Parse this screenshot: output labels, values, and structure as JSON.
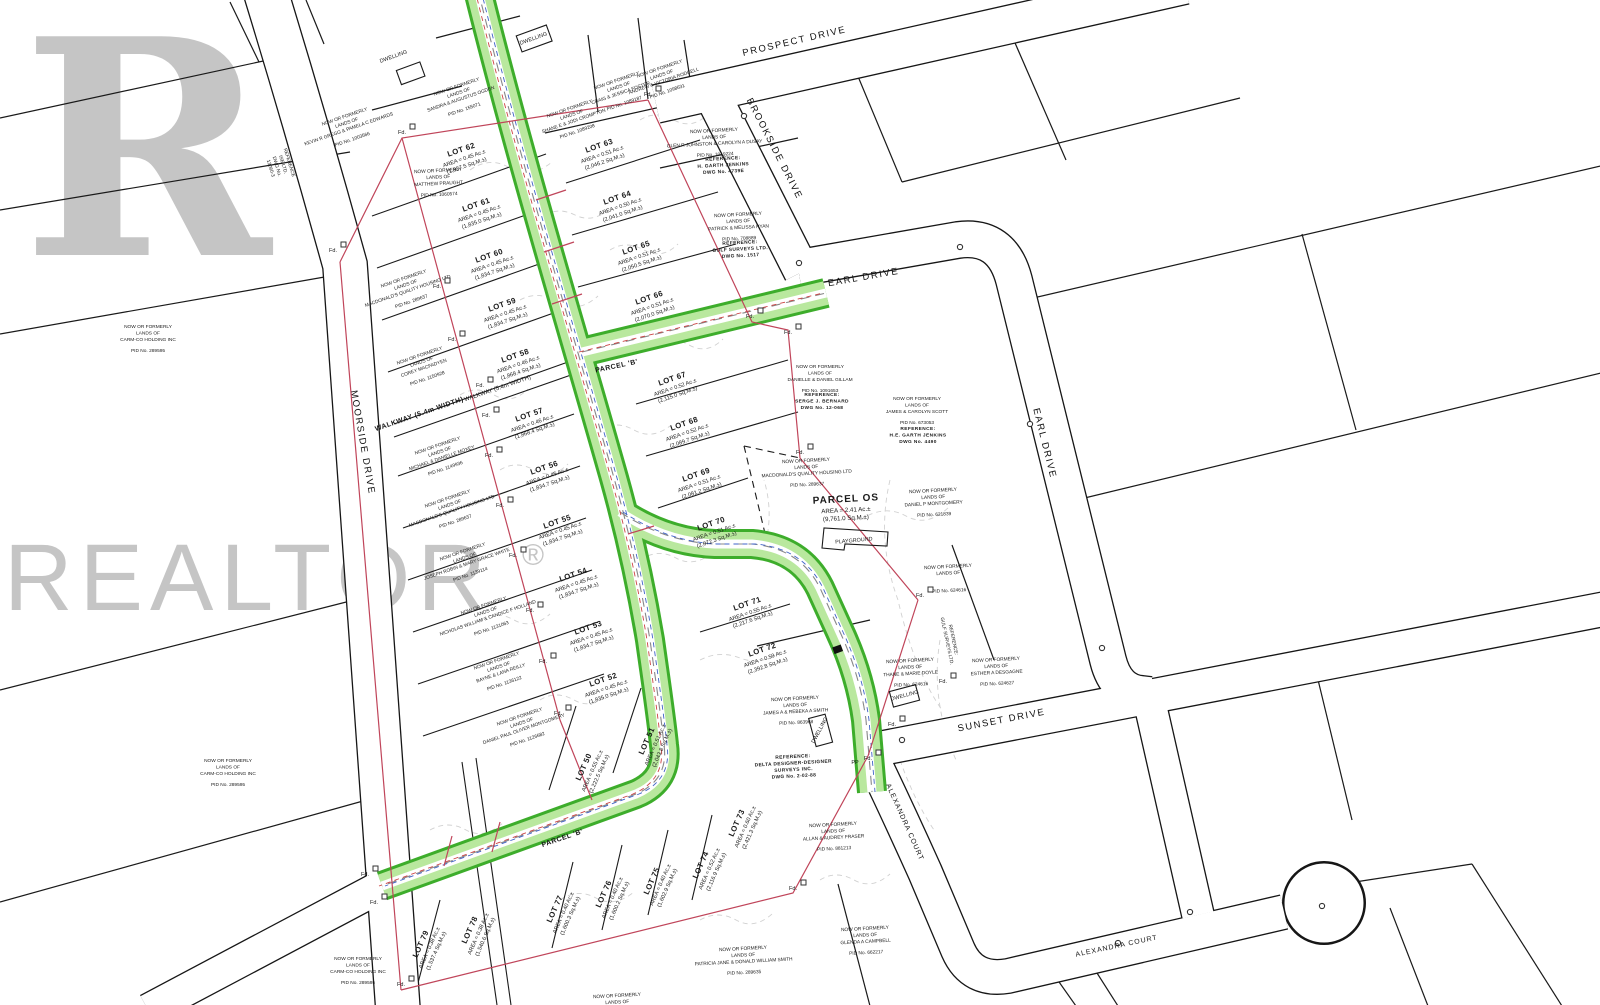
{
  "watermark": {
    "logo_letter": "R",
    "brand": "REALTOR",
    "registered": "®"
  },
  "streets": {
    "prospect": "PROSPECT DRIVE",
    "brookside": "BROOKSIDE DRIVE",
    "earl": "EARL DRIVE",
    "moorside": "MOORSIDE DRIVE",
    "sunset": "SUNSET DRIVE",
    "alexandra": "ALEXANDRA COURT",
    "walkway": "WALKWAY (5.4m WIDTH)",
    "parcel_b": "PARCEL 'B'"
  },
  "parcel_os": {
    "name": "PARCEL OS",
    "area_ac": "AREA = 2.41 Ac.±",
    "area_m": "(9,761.0 Sq.M.±)",
    "playground": "PLAYGROUND"
  },
  "labels": {
    "found": "Fd.",
    "pp": "PP",
    "dwelling": "DWELLING"
  },
  "owner_intro": [
    "NOW OR FORMERLY",
    "LANDS OF"
  ],
  "lots": [
    {
      "id": "LOT 50",
      "ac": "AREA = 0.55 Ac.±",
      "m": "(2,222.5 Sq.M.±)",
      "x": 586,
      "y": 768,
      "r": -66
    },
    {
      "id": "LOT 51",
      "ac": "AREA = 0.51 Ac.±",
      "m": "(2,043.8 Sq.M.±)",
      "x": 649,
      "y": 742,
      "r": -66
    },
    {
      "id": "LOT 52",
      "ac": "AREA = 0.45 Ac.±",
      "m": "(1,835.0 Sq.M.±)",
      "x": 604,
      "y": 682,
      "r": -19
    },
    {
      "id": "LOT 53",
      "ac": "AREA = 0.45 Ac.±",
      "m": "(1,834.7 Sq.M.±)",
      "x": 589,
      "y": 630,
      "r": -19
    },
    {
      "id": "LOT 54",
      "ac": "AREA = 0.45 Ac.±",
      "m": "(1,834.7 Sq.M.±)",
      "x": 574,
      "y": 577,
      "r": -19
    },
    {
      "id": "LOT 55",
      "ac": "AREA = 0.45 Ac.±",
      "m": "(1,834.7 Sq.M.±)",
      "x": 558,
      "y": 524,
      "r": -19
    },
    {
      "id": "LOT 56",
      "ac": "AREA = 0.45 Ac.±",
      "m": "(1,834.7 Sq.M.±)",
      "x": 545,
      "y": 470,
      "r": -19
    },
    {
      "id": "LOT 57",
      "ac": "AREA = 0.46 Ac.±",
      "m": "(1,868.4 Sq.M.±)",
      "x": 530,
      "y": 417,
      "r": -19
    },
    {
      "id": "LOT 58",
      "ac": "AREA = 0.46 Ac.±",
      "m": "(1,868.4 Sq.M.±)",
      "x": 516,
      "y": 358,
      "r": -19
    },
    {
      "id": "LOT 59",
      "ac": "AREA = 0.45 Ac.±",
      "m": "(1,834.7 Sq.M.±)",
      "x": 503,
      "y": 307,
      "r": -19
    },
    {
      "id": "LOT 60",
      "ac": "AREA = 0.45 Ac.±",
      "m": "(1,834.7 Sq.M.±)",
      "x": 490,
      "y": 258,
      "r": -19
    },
    {
      "id": "LOT 61",
      "ac": "AREA = 0.45 Ac.±",
      "m": "(1,835.0 Sq.M.±)",
      "x": 477,
      "y": 207,
      "r": -19
    },
    {
      "id": "LOT 62",
      "ac": "AREA = 0.45 Ac.±",
      "m": "(1,837.5 Sq.M.±)",
      "x": 462,
      "y": 152,
      "r": -19
    },
    {
      "id": "LOT 63",
      "ac": "AREA = 0.51 Ac.±",
      "m": "(2,046.2 Sq.M.±)",
      "x": 600,
      "y": 148,
      "r": -19
    },
    {
      "id": "LOT 64",
      "ac": "AREA = 0.50 Ac.±",
      "m": "(2,041.0 Sq.M.±)",
      "x": 618,
      "y": 200,
      "r": -19
    },
    {
      "id": "LOT 65",
      "ac": "AREA = 0.51 Ac.±",
      "m": "(2,050.5 Sq.M.±)",
      "x": 637,
      "y": 250,
      "r": -19
    },
    {
      "id": "LOT 66",
      "ac": "AREA = 0.51 Ac.±",
      "m": "(2,070.0 Sq.M.±)",
      "x": 650,
      "y": 300,
      "r": -19
    },
    {
      "id": "LOT 67",
      "ac": "AREA = 0.52 Ac.±",
      "m": "(2,115.0 Sq.M.±)",
      "x": 673,
      "y": 381,
      "r": -19
    },
    {
      "id": "LOT 68",
      "ac": "AREA = 0.52 Ac.±",
      "m": "(2,089.7 Sq.M.±)",
      "x": 685,
      "y": 426,
      "r": -19
    },
    {
      "id": "LOT 69",
      "ac": "AREA = 0.51 Ac.±",
      "m": "(2,081.2 Sq.M.±)",
      "x": 697,
      "y": 477,
      "r": -19
    },
    {
      "id": "LOT 70",
      "ac": "AREA = 0.51 Ac.±",
      "m": "(2,072.3 Sq.M.±)",
      "x": 712,
      "y": 526,
      "r": -19
    },
    {
      "id": "LOT 71",
      "ac": "AREA = 0.55 Ac.±",
      "m": "(2,217.6 Sq.M.±)",
      "x": 748,
      "y": 606,
      "r": -19
    },
    {
      "id": "LOT 72",
      "ac": "AREA = 0.59 Ac.±",
      "m": "(2,392.8 Sq.M.±)",
      "x": 763,
      "y": 652,
      "r": -19
    },
    {
      "id": "LOT 73",
      "ac": "AREA = 0.60 Ac.±",
      "m": "(2,421.3 Sq.M.±)",
      "x": 739,
      "y": 824,
      "r": -66
    },
    {
      "id": "LOT 74",
      "ac": "AREA = 0.52 Ac.±",
      "m": "(2,116.9 Sq.M.±)",
      "x": 703,
      "y": 866,
      "r": -66
    },
    {
      "id": "LOT 75",
      "ac": "AREA = 0.40 Ac.±",
      "m": "(1,602.9 Sq.M.±)",
      "x": 654,
      "y": 882,
      "r": -66
    },
    {
      "id": "LOT 76",
      "ac": "AREA = 0.40 Ac.±",
      "m": "(1,600.2 Sq.M.±)",
      "x": 606,
      "y": 895,
      "r": -66
    },
    {
      "id": "LOT 77",
      "ac": "AREA = 0.40 Ac.±",
      "m": "(1,600.3 Sq.M.±)",
      "x": 557,
      "y": 910,
      "r": -66
    },
    {
      "id": "LOT 78",
      "ac": "AREA = 0.38 Ac.±",
      "m": "(1,540.6 Sq.M.±)",
      "x": 472,
      "y": 931,
      "r": -66
    },
    {
      "id": "LOT 79",
      "ac": "AREA = 0.38 Ac.±",
      "m": "(1,537.4 Sq.M.±)",
      "x": 423,
      "y": 945,
      "r": -66
    }
  ],
  "owners": [
    {
      "name": "KEVIN R GREGG & PAMELA C EDWARDS",
      "pid": "PID No. 1003566",
      "x": 345,
      "y": 118,
      "r": -19
    },
    {
      "name": "MATTHEW PRAUGHT",
      "pid": "PID No. 1060574",
      "x": 438,
      "y": 172,
      "r": -3
    },
    {
      "name": "SANDRA & AUGUSTUS OGDEN",
      "pid": "PID No. 155071",
      "x": 457,
      "y": 88,
      "r": -19
    },
    {
      "name": "SHANE E & JODI CROMPTON",
      "pid": "PID No. 1089208",
      "x": 570,
      "y": 110,
      "r": -19
    },
    {
      "name": "CRAIG & JESSICA FOSTER",
      "pid": "PID No. 1089187",
      "x": 617,
      "y": 82,
      "r": -19
    },
    {
      "name": "ANDREW & VICTORIA RODGELL",
      "pid": "PID No. 1098631",
      "x": 660,
      "y": 70,
      "r": -19
    },
    {
      "name": "GLEN R JOHNSTON & CAROLYN A DUSAY",
      "pid": "PID No. 1019224",
      "x": 714,
      "y": 132,
      "r": -3
    },
    {
      "name": "PATRICK & MELISSA RYAN",
      "pid": "PID No. 708889",
      "x": 738,
      "y": 216,
      "r": -3
    },
    {
      "name": "COREY MACFADYEN",
      "pid": "PID No. 1150928",
      "x": 420,
      "y": 357,
      "r": -19
    },
    {
      "name": "MICHAEL & DANIELLE MOXEY",
      "pid": "PID No. 1149936",
      "x": 438,
      "y": 447,
      "r": -19
    },
    {
      "name": "MACDONALD'S QUALITY HOUSING LTD",
      "pid": "PID No. 289637",
      "x": 448,
      "y": 500,
      "r": -19
    },
    {
      "name": "MACDONALD'S QUALITY HOUSING LTD",
      "pid": "PID No. 289637",
      "x": 404,
      "y": 280,
      "r": -19
    },
    {
      "name": "JOSEPH ROBIN & MARY GRACE WHITE",
      "pid": "PID No. 1139114",
      "x": 463,
      "y": 553,
      "r": -19
    },
    {
      "name": "NICHOLAS WILLIAM & CANDICE F HOLLAND",
      "pid": "PID No. 1131063",
      "x": 484,
      "y": 607,
      "r": -19
    },
    {
      "name": "BAYNE & LANA REILLY",
      "pid": "PID No. 1136122",
      "x": 497,
      "y": 662,
      "r": -19
    },
    {
      "name": "DANIEL PAUL OLIVER MONTGOMERY",
      "pid": "PID No. 1126682",
      "x": 520,
      "y": 718,
      "r": -19
    },
    {
      "name": "CARM-CO HOLDING INC",
      "pid": "PID No. 289595",
      "x": 148,
      "y": 328,
      "r": 0
    },
    {
      "name": "CARM-CO HOLDING INC",
      "pid": "PID No. 289595",
      "x": 228,
      "y": 762,
      "r": 0
    },
    {
      "name": "CARM-CO HOLDING INC",
      "pid": "PID No. 289595",
      "x": 358,
      "y": 960,
      "r": 0
    },
    {
      "name": "DANIELLE & DANIEL GILLAM",
      "pid": "PID No. 1091653",
      "x": 820,
      "y": 368,
      "r": 0
    },
    {
      "name": "MACDONALD'S QUALITY HOUSING LTD",
      "pid": "PID No. 289637",
      "x": 806,
      "y": 462,
      "r": -3
    },
    {
      "name": "JAMES & CAROLYN SCOTT",
      "pid": "PID No. 673053",
      "x": 917,
      "y": 400,
      "r": 0
    },
    {
      "name": "DANIEL P MONTGOMERY",
      "pid": "PID No. 621839",
      "x": 933,
      "y": 492,
      "r": -3
    },
    {
      "name": "",
      "pid": "PID No. 624616",
      "x": 948,
      "y": 568,
      "r": -3
    },
    {
      "name": "THANE & MARIE DOYLE",
      "pid": "PID No. 624616",
      "x": 910,
      "y": 662,
      "r": -3
    },
    {
      "name": "ESTHER A DESGAGNE",
      "pid": "PID No. 624627",
      "x": 996,
      "y": 661,
      "r": -3
    },
    {
      "name": "JAMES A & REBEKA A SMITH",
      "pid": "PID No. 863968",
      "x": 795,
      "y": 700,
      "r": -3
    },
    {
      "name": "ALLAN & AUDREY FRASER",
      "pid": "PID No. 881213",
      "x": 833,
      "y": 826,
      "r": -3
    },
    {
      "name": "GLENDA A CAMPBELL",
      "pid": "PID No. 662217",
      "x": 865,
      "y": 930,
      "r": -3
    },
    {
      "name": "PATRICIA JANE & DONALD WILLIAM SMITH",
      "pid": "PID No. 289635",
      "x": 743,
      "y": 950,
      "r": -3
    }
  ],
  "references": [
    {
      "lines": [
        "REFERENCE:",
        "H. GARTH JENKINS",
        "DWG No. 4739E"
      ],
      "bold": true,
      "x": 723,
      "y": 160,
      "r": -3
    },
    {
      "lines": [
        "REFERENCE:",
        "GULF SURVEYS LTD.",
        "DWG No. 1517"
      ],
      "bold": true,
      "x": 740,
      "y": 244,
      "r": -3
    },
    {
      "lines": [
        "REFERENCE:",
        "SERGE J. BERNARD",
        "DWG No. 12-068"
      ],
      "bold": true,
      "x": 822,
      "y": 396,
      "r": 0
    },
    {
      "lines": [
        "REFERENCE:",
        "H.E. GARTH JENKINS",
        "DWG No. 4490"
      ],
      "bold": true,
      "x": 918,
      "y": 430,
      "r": 0
    },
    {
      "lines": [
        "REFERENCE:",
        "DELTA DESIGNER-DESIGNER",
        "SURVEYS INC.",
        "DWG No. 2-02-88"
      ],
      "bold": true,
      "x": 793,
      "y": 758,
      "r": -3
    },
    {
      "lines": [
        "REFERENCE",
        "ISE LTD.",
        "DWG No.",
        "13060-3"
      ],
      "bold": false,
      "x": 288,
      "y": 163,
      "r": 73
    },
    {
      "lines": [
        "REFERENCE:",
        "GULF SURVEYS LTD."
      ],
      "bold": false,
      "x": 952,
      "y": 640,
      "r": 78
    },
    {
      "lines": [
        "NOW OR FORMERLY",
        "LANDS OF"
      ],
      "bold": false,
      "x": 617,
      "y": 997,
      "r": -3
    }
  ],
  "fd_positions": [
    [
      333,
      252
    ],
    [
      402,
      134
    ],
    [
      648,
      96
    ],
    [
      750,
      318
    ],
    [
      788,
      334
    ],
    [
      800,
      454
    ],
    [
      920,
      597
    ],
    [
      868,
      760
    ],
    [
      793,
      890
    ],
    [
      401,
      986
    ],
    [
      365,
      876
    ],
    [
      374,
      904
    ],
    [
      437,
      288
    ],
    [
      452,
      341
    ],
    [
      480,
      387
    ],
    [
      486,
      417
    ],
    [
      489,
      457
    ],
    [
      500,
      507
    ],
    [
      513,
      557
    ],
    [
      530,
      612
    ],
    [
      543,
      663
    ],
    [
      558,
      715
    ],
    [
      892,
      726
    ],
    [
      943,
      683
    ]
  ],
  "colors": {
    "line_black": "#1a1a1a",
    "boundary_red": "#c0455a",
    "road_green_edge": "#3dad2b",
    "road_green_fill": "#b9e89e",
    "utility_blue": "#3f63c8",
    "utility_red": "#cc4444",
    "watermark_gray": "#bcbcbc"
  }
}
